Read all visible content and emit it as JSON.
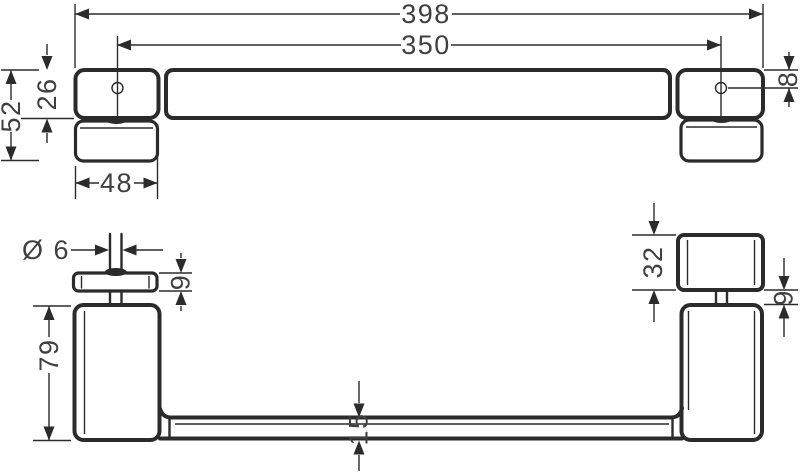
{
  "drawing": {
    "type": "technical-dimension-drawing",
    "views": {
      "top_view": {
        "dimensions": {
          "overall_length": "398",
          "hole_spacing": "350",
          "plate_width": "48",
          "total_depth": "52",
          "bar_depth": "26",
          "hole_edge_offset": "8"
        }
      },
      "front_view": {
        "dimensions": {
          "screw_diameter": "Ø 6",
          "flange_thickness": "9",
          "post_height": "79",
          "bar_thickness": "15",
          "knob_height": "32",
          "knob_gap": "9"
        }
      }
    },
    "colors": {
      "line": "#2b2b2b",
      "text": "#3f3f3f",
      "background": "#ffffff"
    }
  }
}
